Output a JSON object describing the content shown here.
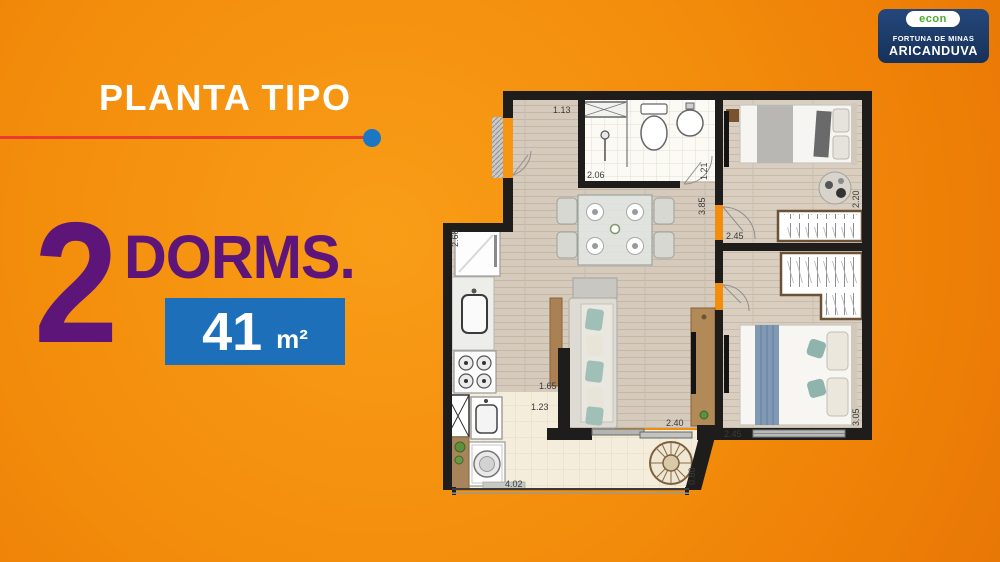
{
  "header": {
    "title": "PLANTA TIPO"
  },
  "offer": {
    "quantity": "2",
    "label": "DORMS.",
    "area_value": "41",
    "area_unit": "m²"
  },
  "logo": {
    "brand": "econ",
    "line1": "FORTUNA DE MINAS",
    "line2": "ARICANDUVA"
  },
  "colors": {
    "background_orange": "#F38D0C",
    "purple": "#5E1579",
    "area_badge_blue": "#1C6FB8",
    "rule_red": "#E93C2D",
    "dot_blue": "#1B76C4",
    "logo_navy": "#1C3A66",
    "logo_green": "#4AAD2C"
  },
  "plan": {
    "dims": [
      "1.13",
      "2.06",
      "1.21",
      "3.85",
      "2.20",
      "2.45",
      "2.68",
      "1.65",
      "1.23",
      "2.40",
      "2.45",
      "3.05",
      "4.02",
      "0.80"
    ]
  }
}
